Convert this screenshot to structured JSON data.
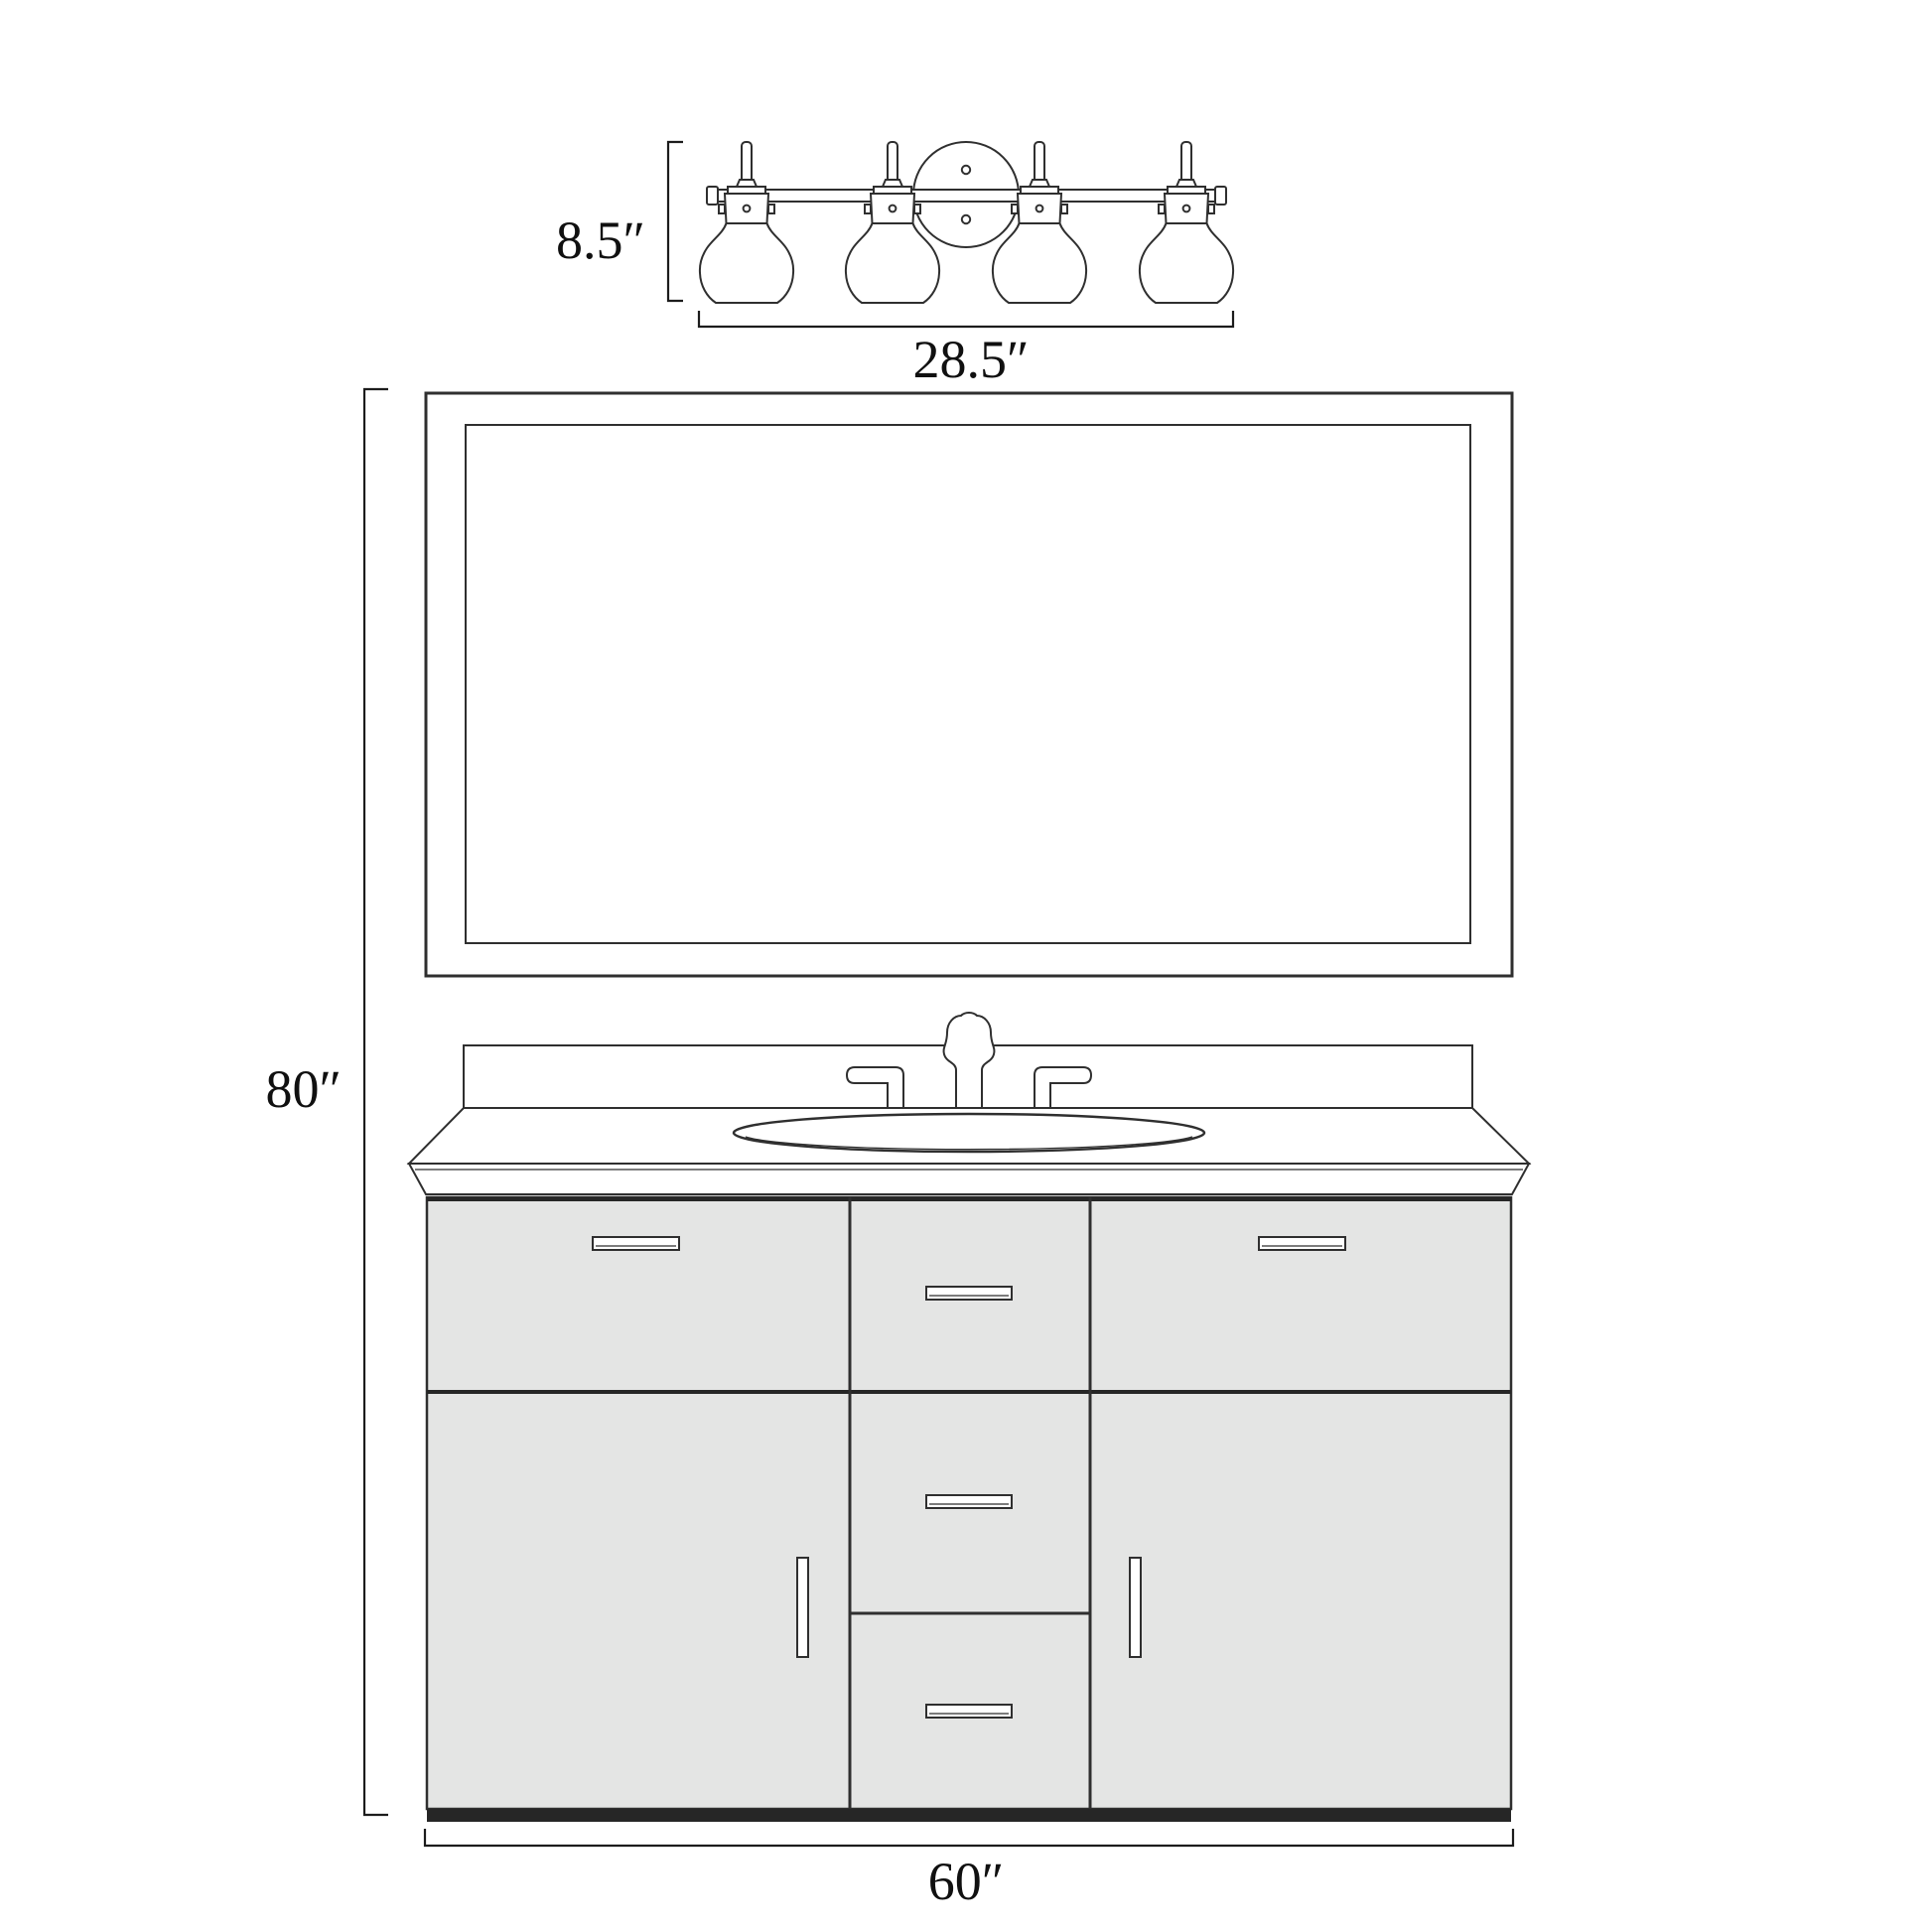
{
  "diagram": {
    "kind": "bathroom-vanity-dimension-drawing",
    "background": "#ffffff",
    "colors": {
      "line": "#2f2f2f",
      "dim": "#1c1c1c",
      "cabinet_fill": "#e4e5e4",
      "cabinet_trim": "#262626"
    },
    "labels": {
      "light_height": "8.5″",
      "light_width": "28.5″",
      "assembly_height": "80″",
      "vanity_width": "60″"
    },
    "fixture": {
      "shade_count": 4
    },
    "vanity": {
      "door_count": 4,
      "drawer_count": 3
    }
  }
}
